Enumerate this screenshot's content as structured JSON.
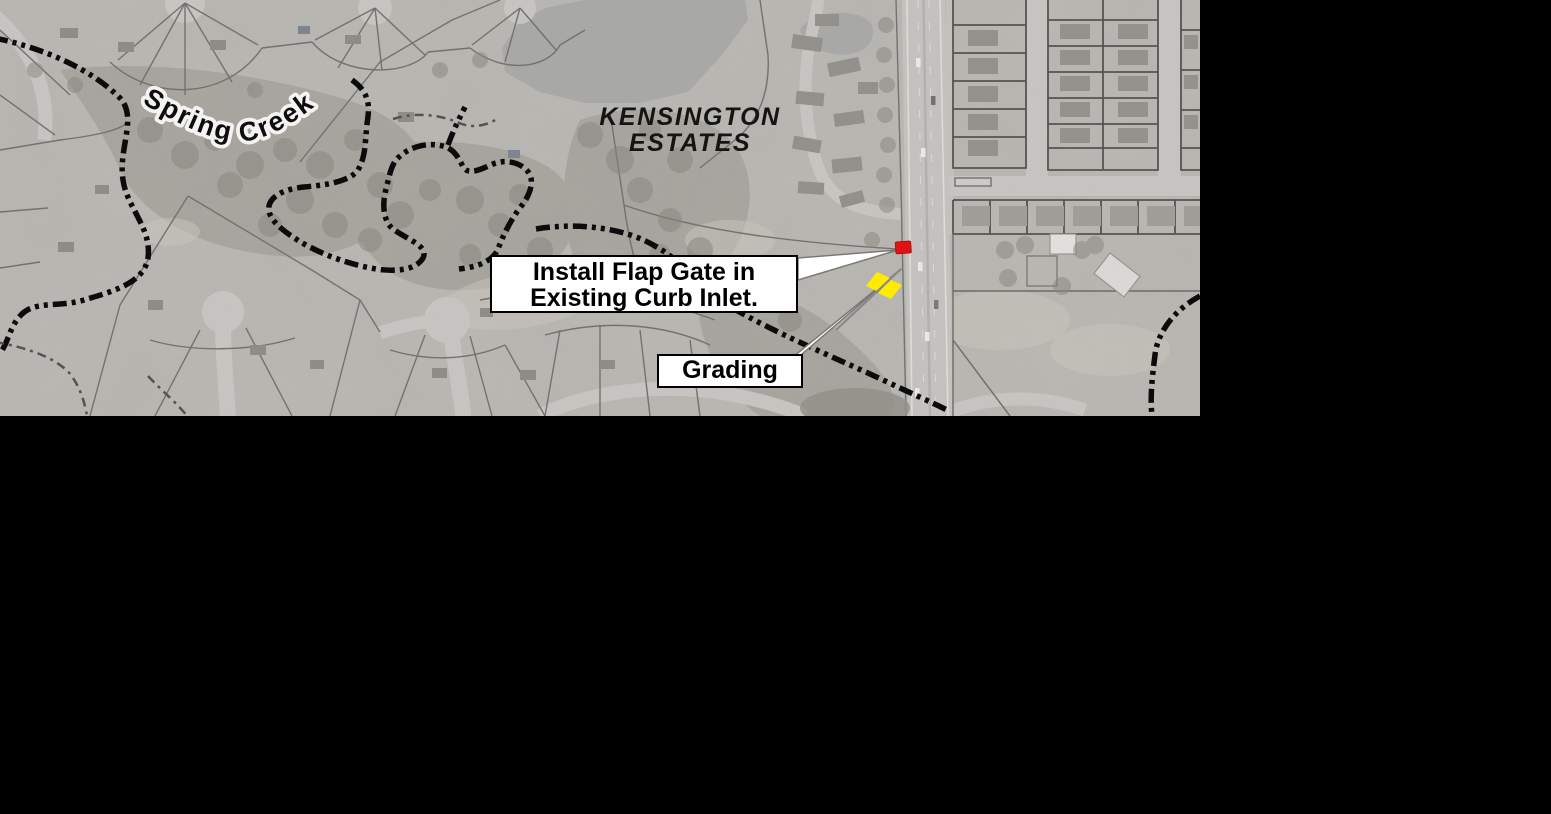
{
  "map": {
    "creek_label": "Spring Creek",
    "subdivision_label": {
      "line1": "KENSINGTON",
      "line2": "ESTATES"
    },
    "callouts": {
      "flap_gate": {
        "line1": "Install Flap Gate in",
        "line2": "Existing Curb Inlet."
      },
      "grading": "Grading"
    },
    "markers": {
      "flap_gate": {
        "color": "#e31111"
      },
      "grading": {
        "color": "#ffeb00"
      }
    },
    "colors": {
      "background": "#000000",
      "aerial_base": "#b7b5b1",
      "callout_bg": "#ffffff",
      "callout_border": "#000000",
      "floodplain_dash": "#0b0b0b"
    }
  }
}
